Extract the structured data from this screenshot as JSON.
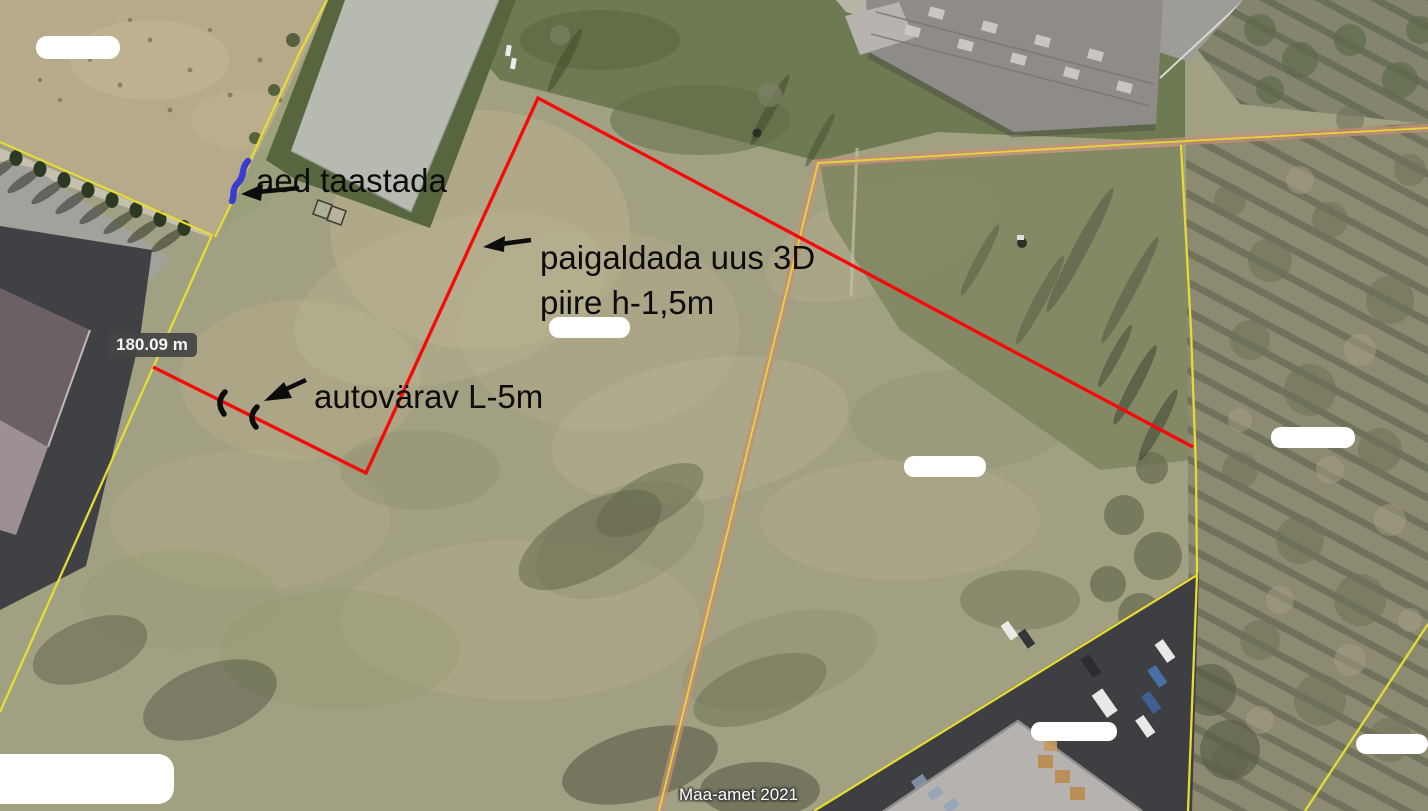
{
  "map": {
    "attribution": "Maa-amet 2021",
    "measurement": {
      "label": "180.09 m"
    },
    "annotations": {
      "fence_restore": "aed taastada",
      "new_fence_line1": "paigaldada uus 3D",
      "new_fence_line2": "piire h-1,5m",
      "gate": "autovärav L-5m"
    },
    "colors": {
      "fence_red": "#f80808",
      "cadastral_yellow": "#e6da35",
      "cadastral_orange": "#c98e76",
      "note_blue": "#3b3dd0",
      "annotation_text": "#0c0c0c",
      "measurement_bg": "#454545",
      "measurement_text": "#ffffff"
    }
  }
}
